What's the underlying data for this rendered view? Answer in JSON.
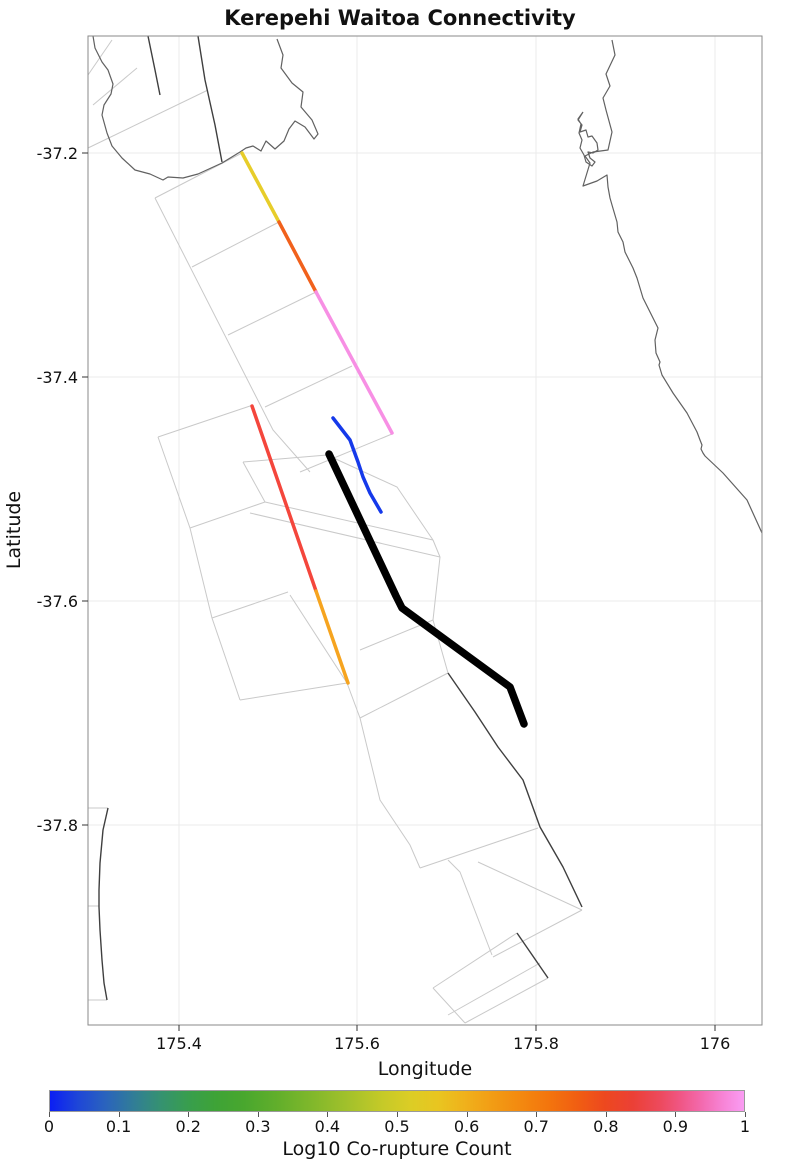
{
  "title": "Kerepehi Waitoa Connectivity",
  "axes": {
    "xlabel": "Longitude",
    "ylabel": "Latitude",
    "xticks": [
      {
        "label": "175.4",
        "px": 179
      },
      {
        "label": "175.6",
        "px": 357
      },
      {
        "label": "175.8",
        "px": 536
      },
      {
        "label": "176",
        "px": 715
      }
    ],
    "yticks": [
      {
        "label": "-37.2",
        "px": 153
      },
      {
        "label": "-37.4",
        "px": 377
      },
      {
        "label": "-37.6",
        "px": 601
      },
      {
        "label": "-37.8",
        "px": 825
      }
    ],
    "xlim": [
      175.295,
      176.053
    ],
    "ylim": [
      -37.979,
      -37.095
    ]
  },
  "colorbar": {
    "label": "Log10 Co-rupture Count",
    "ticks": [
      "0",
      "0.1",
      "0.2",
      "0.3",
      "0.4",
      "0.5",
      "0.6",
      "0.7",
      "0.8",
      "0.9",
      "1"
    ],
    "range": [
      0,
      1
    ],
    "stops": [
      [
        0,
        "#0b1ef4"
      ],
      [
        4,
        "#1e46d8"
      ],
      [
        8,
        "#2a63bd"
      ],
      [
        12,
        "#317d97"
      ],
      [
        16,
        "#359270"
      ],
      [
        20,
        "#389e4d"
      ],
      [
        24,
        "#3ea336"
      ],
      [
        28,
        "#49a72e"
      ],
      [
        33,
        "#63af2b"
      ],
      [
        38,
        "#82b82b"
      ],
      [
        43,
        "#a3c12b"
      ],
      [
        48,
        "#c6ca28"
      ],
      [
        52,
        "#dccd25"
      ],
      [
        56,
        "#e9c520"
      ],
      [
        60,
        "#f0b01b"
      ],
      [
        64,
        "#f29b14"
      ],
      [
        68,
        "#f3880f"
      ],
      [
        72,
        "#f3740d"
      ],
      [
        76,
        "#f15e12"
      ],
      [
        80,
        "#ed481f"
      ],
      [
        84,
        "#eb4036"
      ],
      [
        88,
        "#ed4a5e"
      ],
      [
        91,
        "#f05787"
      ],
      [
        94,
        "#f36bb0"
      ],
      [
        97,
        "#f784d6"
      ],
      [
        100,
        "#fa9cf3"
      ]
    ]
  },
  "chart_data": {
    "type": "line",
    "title": "Kerepehi Waitoa Connectivity",
    "xlabel": "Longitude",
    "ylabel": "Latitude",
    "xlim": [
      175.295,
      176.053
    ],
    "ylim": [
      -37.979,
      -37.095
    ],
    "grid": true,
    "colorbar_label": "Log10 Co-rupture Count",
    "colorbar_range": [
      0,
      1
    ],
    "series": [
      {
        "name": "rupture-segment-yellow",
        "log10_value": 0.48,
        "color": "#e7cd2a",
        "width": 3.5,
        "points_lonlat": [
          [
            175.471,
            -37.2
          ],
          [
            175.512,
            -37.262
          ]
        ],
        "px": [
          [
            242,
            153
          ],
          [
            279,
            222
          ]
        ]
      },
      {
        "name": "rupture-segment-orange-upper",
        "log10_value": 0.72,
        "color": "#f1611c",
        "width": 3.5,
        "points_lonlat": [
          [
            175.512,
            -37.262
          ],
          [
            175.554,
            -37.324
          ]
        ],
        "px": [
          [
            279,
            222
          ],
          [
            316,
            292
          ]
        ]
      },
      {
        "name": "rupture-segment-pink",
        "log10_value": 0.97,
        "color": "#f78fe4",
        "width": 3.5,
        "points_lonlat": [
          [
            175.554,
            -37.324
          ],
          [
            175.639,
            -37.45
          ]
        ],
        "px": [
          [
            316,
            292
          ],
          [
            392,
            433
          ]
        ]
      },
      {
        "name": "rupture-segment-red",
        "log10_value": 0.85,
        "color": "#f4463c",
        "width": 3.5,
        "points_lonlat": [
          [
            175.482,
            -37.426
          ],
          [
            175.554,
            -37.591
          ]
        ],
        "px": [
          [
            252,
            406
          ],
          [
            316,
            591
          ]
        ]
      },
      {
        "name": "rupture-segment-orange-lower",
        "log10_value": 0.6,
        "color": "#f6a41f",
        "width": 3.5,
        "points_lonlat": [
          [
            175.554,
            -37.591
          ],
          [
            175.59,
            -37.673
          ]
        ],
        "px": [
          [
            316,
            591
          ],
          [
            348,
            683
          ]
        ]
      },
      {
        "name": "rupture-segment-blue",
        "log10_value": 0.02,
        "color": "#1539ea",
        "width": 3.5,
        "points_lonlat": [
          [
            175.573,
            -37.437
          ],
          [
            175.592,
            -37.456
          ],
          [
            175.601,
            -37.476
          ],
          [
            175.607,
            -37.489
          ],
          [
            175.615,
            -37.504
          ],
          [
            175.627,
            -37.521
          ]
        ],
        "px": [
          [
            333,
            418
          ],
          [
            350,
            440
          ],
          [
            358,
            462
          ],
          [
            363,
            477
          ],
          [
            370,
            493
          ],
          [
            381,
            512
          ]
        ]
      },
      {
        "name": "highlighted-fault-trace-black",
        "log10_value": null,
        "color": "#000000",
        "width": 7.5,
        "points_lonlat": [
          [
            175.569,
            -37.469
          ],
          [
            175.644,
            -37.596
          ],
          [
            175.651,
            -37.606
          ],
          [
            175.772,
            -37.677
          ],
          [
            175.788,
            -37.71
          ]
        ],
        "px": [
          [
            329,
            454
          ],
          [
            396,
            596
          ],
          [
            402,
            608
          ],
          [
            510,
            687
          ],
          [
            524,
            724
          ]
        ]
      }
    ]
  },
  "basemap_px": {
    "coast": [
      [
        [
          93,
          36
        ],
        [
          95,
          48
        ],
        [
          102,
          62
        ],
        [
          108,
          70
        ],
        [
          113,
          84
        ],
        [
          111,
          94
        ],
        [
          104,
          105
        ],
        [
          102,
          115
        ],
        [
          107,
          133
        ],
        [
          112,
          146
        ],
        [
          122,
          158
        ],
        [
          135,
          170
        ],
        [
          150,
          174
        ],
        [
          163,
          180
        ],
        [
          168,
          177
        ],
        [
          183,
          178
        ],
        [
          198,
          174
        ],
        [
          222,
          163
        ],
        [
          240,
          152
        ],
        [
          246,
          148
        ],
        [
          253,
          146
        ],
        [
          261,
          151
        ],
        [
          266,
          141
        ],
        [
          275,
          149
        ],
        [
          284,
          141
        ],
        [
          289,
          129
        ],
        [
          295,
          121
        ],
        [
          305,
          127
        ],
        [
          314,
          139
        ],
        [
          318,
          134
        ],
        [
          312,
          120
        ],
        [
          301,
          107
        ],
        [
          303,
          92
        ],
        [
          292,
          83
        ],
        [
          281,
          68
        ],
        [
          283,
          55
        ],
        [
          277,
          39
        ]
      ],
      [
        [
          612,
          40
        ],
        [
          615,
          55
        ],
        [
          606,
          74
        ],
        [
          610,
          86
        ],
        [
          603,
          98
        ],
        [
          606,
          110
        ],
        [
          612,
          132
        ],
        [
          608,
          150
        ],
        [
          593,
          152
        ],
        [
          585,
          156
        ],
        [
          590,
          163
        ],
        [
          583,
          186
        ],
        [
          597,
          181
        ],
        [
          607,
          175
        ],
        [
          608,
          187
        ],
        [
          610,
          198
        ],
        [
          612,
          205
        ],
        [
          617,
          222
        ],
        [
          618,
          232
        ],
        [
          623,
          242
        ],
        [
          625,
          252
        ],
        [
          630,
          262
        ],
        [
          633,
          268
        ],
        [
          637,
          278
        ],
        [
          643,
          298
        ],
        [
          648,
          308
        ],
        [
          653,
          318
        ],
        [
          658,
          328
        ],
        [
          655,
          340
        ],
        [
          656,
          353
        ],
        [
          660,
          362
        ],
        [
          659,
          365
        ],
        [
          662,
          375
        ],
        [
          673,
          393
        ],
        [
          687,
          413
        ],
        [
          697,
          432
        ],
        [
          700,
          440
        ],
        [
          702,
          445
        ],
        [
          701,
          449
        ],
        [
          703,
          453
        ],
        [
          705,
          456
        ],
        [
          723,
          473
        ],
        [
          747,
          500
        ],
        [
          762,
          533
        ]
      ],
      [
        [
          583,
          112
        ],
        [
          578,
          120
        ],
        [
          582,
          125
        ],
        [
          580,
          132
        ],
        [
          586,
          130
        ],
        [
          588,
          137
        ],
        [
          592,
          136
        ],
        [
          597,
          143
        ],
        [
          598,
          150
        ],
        [
          593,
          153
        ],
        [
          588,
          152
        ],
        [
          590,
          158
        ],
        [
          595,
          162
        ],
        [
          592,
          166
        ],
        [
          586,
          162
        ],
        [
          584,
          155
        ],
        [
          580,
          148
        ],
        [
          582,
          140
        ],
        [
          579,
          133
        ],
        [
          581,
          124
        ],
        [
          578,
          119
        ],
        [
          583,
          112
        ]
      ]
    ],
    "dark": [
      [
        [
          198,
          36
        ],
        [
          205,
          80
        ],
        [
          215,
          125
        ],
        [
          222,
          162
        ]
      ],
      [
        [
          148,
          36
        ],
        [
          155,
          70
        ],
        [
          160,
          95
        ]
      ],
      [
        [
          448,
          673
        ],
        [
          475,
          712
        ],
        [
          498,
          747
        ],
        [
          523,
          780
        ],
        [
          540,
          827
        ],
        [
          563,
          867
        ],
        [
          582,
          907
        ]
      ],
      [
        [
          517,
          933
        ],
        [
          548,
          978
        ]
      ],
      [
        [
          108,
          808
        ],
        [
          103,
          830
        ],
        [
          100,
          863
        ],
        [
          99,
          890
        ],
        [
          99,
          907
        ],
        [
          100,
          930
        ],
        [
          102,
          960
        ],
        [
          104,
          983
        ],
        [
          107,
          1000
        ]
      ]
    ],
    "faint": [
      [
        [
          155,
          198
        ],
        [
          273,
          430
        ],
        [
          310,
          472
        ]
      ],
      [
        [
          155,
          198
        ],
        [
          242,
          153
        ]
      ],
      [
        [
          192,
          267
        ],
        [
          279,
          222
        ]
      ],
      [
        [
          228,
          335
        ],
        [
          316,
          292
        ]
      ],
      [
        [
          265,
          407
        ],
        [
          352,
          366
        ]
      ],
      [
        [
          300,
          472
        ],
        [
          392,
          434
        ]
      ],
      [
        [
          88,
          148
        ],
        [
          208,
          90
        ]
      ],
      [
        [
          88,
          75
        ],
        [
          112,
          40
        ]
      ],
      [
        [
          93,
          105
        ],
        [
          137,
          68
        ]
      ],
      [
        [
          158,
          437
        ],
        [
          190,
          528
        ],
        [
          212,
          618
        ],
        [
          240,
          700
        ]
      ],
      [
        [
          158,
          437
        ],
        [
          253,
          405
        ]
      ],
      [
        [
          190,
          528
        ],
        [
          265,
          502
        ]
      ],
      [
        [
          212,
          618
        ],
        [
          288,
          592
        ]
      ],
      [
        [
          240,
          700
        ],
        [
          347,
          683
        ]
      ],
      [
        [
          243,
          462
        ],
        [
          327,
          455
        ]
      ],
      [
        [
          243,
          462
        ],
        [
          265,
          502
        ]
      ],
      [
        [
          327,
          455
        ],
        [
          397,
          487
        ],
        [
          433,
          540
        ]
      ],
      [
        [
          265,
          502
        ],
        [
          433,
          540
        ]
      ],
      [
        [
          250,
          513
        ],
        [
          440,
          557
        ]
      ],
      [
        [
          433,
          540
        ],
        [
          440,
          557
        ]
      ],
      [
        [
          440,
          557
        ],
        [
          433,
          620
        ],
        [
          448,
          673
        ]
      ],
      [
        [
          360,
          650
        ],
        [
          433,
          620
        ]
      ],
      [
        [
          290,
          595
        ],
        [
          347,
          683
        ]
      ],
      [
        [
          347,
          683
        ],
        [
          360,
          718
        ]
      ],
      [
        [
          360,
          718
        ],
        [
          448,
          673
        ]
      ],
      [
        [
          360,
          718
        ],
        [
          380,
          800
        ],
        [
          410,
          845
        ],
        [
          420,
          868
        ]
      ],
      [
        [
          420,
          868
        ],
        [
          538,
          828
        ]
      ],
      [
        [
          448,
          860
        ],
        [
          460,
          872
        ],
        [
          492,
          955
        ]
      ],
      [
        [
          478,
          862
        ],
        [
          582,
          910
        ]
      ],
      [
        [
          582,
          910
        ],
        [
          493,
          957
        ]
      ],
      [
        [
          433,
          988
        ],
        [
          517,
          933
        ]
      ],
      [
        [
          548,
          978
        ],
        [
          465,
          1023
        ]
      ],
      [
        [
          465,
          1023
        ],
        [
          433,
          988
        ]
      ],
      [
        [
          448,
          1015
        ],
        [
          540,
          963
        ]
      ],
      [
        [
          88,
          808
        ],
        [
          108,
          808
        ]
      ],
      [
        [
          88,
          906
        ],
        [
          99,
          906
        ]
      ],
      [
        [
          88,
          1000
        ],
        [
          107,
          1000
        ]
      ]
    ]
  },
  "layout_px": {
    "plot": {
      "left": 88,
      "top": 36,
      "right": 762,
      "bottom": 1025
    },
    "colorbar": {
      "left": 49,
      "top": 1090,
      "width": 696,
      "height": 22
    }
  }
}
